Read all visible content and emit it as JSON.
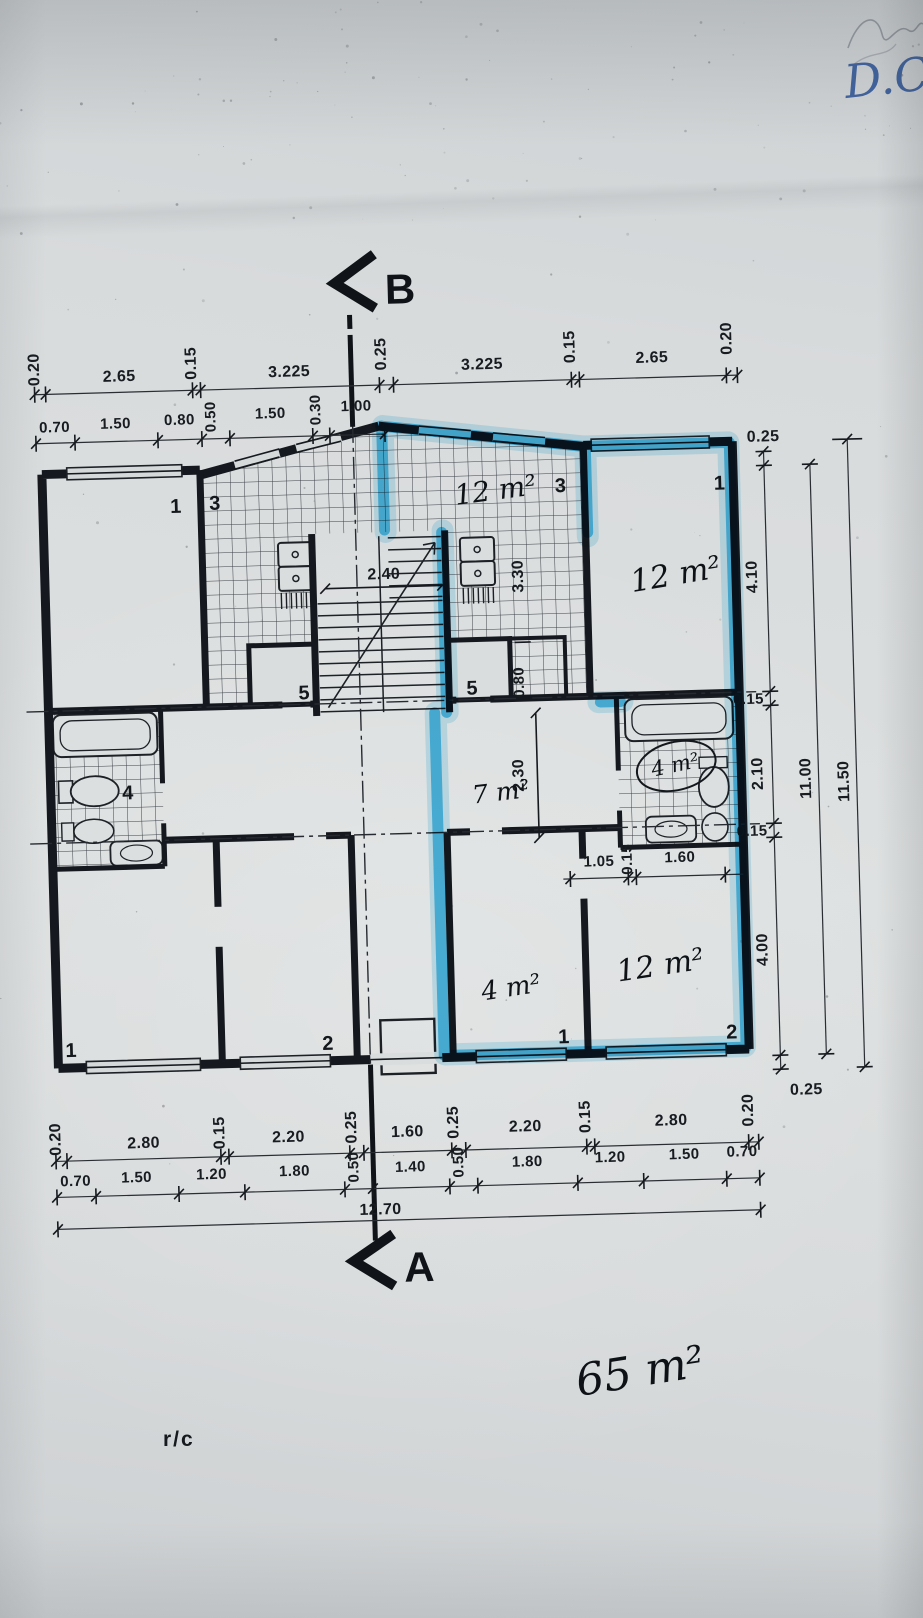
{
  "meta": {
    "description": "Photographed architectural floor plan of a two-apartment storey; right apartment outlined with blue highlighter",
    "paper_color": "#d9dcdd",
    "ink_color": "#1d2126",
    "highlight_color": "#38b7e8",
    "pen_color": "#40639f"
  },
  "markers": {
    "top": "B",
    "bottom": "A"
  },
  "labels": {
    "floor": "r/c",
    "corner_note": "D.C"
  },
  "rooms": {
    "numbers": {
      "left_top": "1",
      "left_kitchen": "3",
      "right_kitchen": "3",
      "right_top": "1",
      "left_store": "5",
      "right_store": "5",
      "left_bath": "4",
      "left_bottom1": "1",
      "left_bottom2": "2",
      "right_bottom1": "1",
      "right_bottom2": "2"
    },
    "areas": {
      "loggia": "12 m²",
      "right_top_room": "12 m²",
      "hall": "7 m²",
      "bathroom": "4 m²",
      "right_small_room": "4 m²",
      "right_bottom_room": "12 m²",
      "apartment_total": "65 m²"
    }
  },
  "dims": {
    "top_row1": [
      "0.20",
      "2.65",
      "0.15",
      "3.225",
      "0.25",
      "3.225",
      "0.15",
      "2.65",
      "0.20"
    ],
    "top_row2": [
      "0.70",
      "1.50",
      "0.80",
      "0.50",
      "1.50",
      "0.30",
      "1.00"
    ],
    "right_col": [
      "0.25",
      "4.10",
      "0.15",
      "2.10",
      "0.15",
      "4.00"
    ],
    "right_bottom": "0.25",
    "right_total_inner": "11.00",
    "right_total_outer": "11.50",
    "bottom_row1": [
      "0.20",
      "2.80",
      "0.15",
      "2.20",
      "0.25",
      "1.60",
      "0.25",
      "2.20",
      "0.15",
      "2.80",
      "0.20"
    ],
    "bottom_row2": [
      "0.70",
      "1.50",
      "1.20",
      "1.80",
      "0.50",
      "1.40",
      "0.50",
      "1.80",
      "1.20",
      "1.50",
      "0.70"
    ],
    "bottom_total": "12.70",
    "interior": {
      "stair_width": "2.40",
      "kitchen_depth": "3.30",
      "closet": "0.80",
      "hall_depth": "2.30",
      "bath_row": [
        "1.05",
        "0.15",
        "1.60"
      ]
    }
  }
}
